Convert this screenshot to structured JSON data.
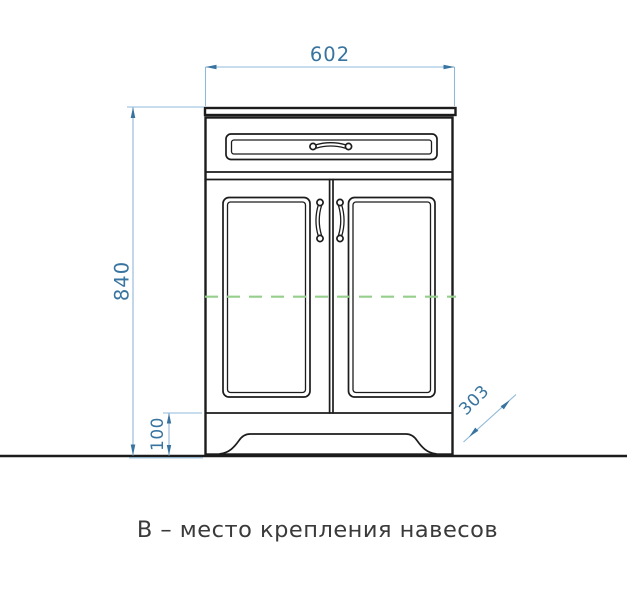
{
  "drawing": {
    "caption": "В – место крепления навесов",
    "dimension_labels": {
      "width": "602",
      "height": "840",
      "plinth": "100",
      "depth": "303"
    },
    "colors": {
      "outline": "#1c1c1c",
      "dimension-accent": "#38749f",
      "dimension-line": "#8fb9d9",
      "mounting-green": "#95cf8b",
      "caption-text": "#3a3a3a",
      "background": "#ffffff"
    }
  }
}
